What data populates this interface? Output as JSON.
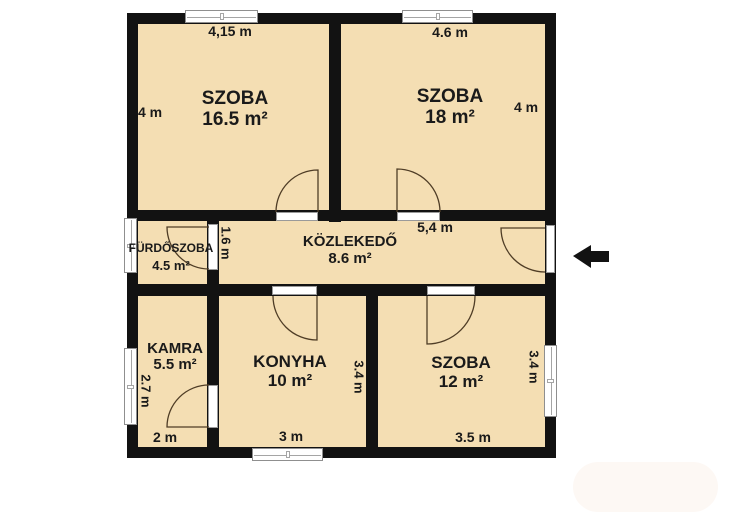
{
  "plan_type": "apartment-floor-plan",
  "colors": {
    "floor": "#f4deb3",
    "wall": "#121212",
    "text": "#1a1a1a",
    "door_arc": "#4f3d26",
    "window_frame": "#8f8f8f"
  },
  "rooms": [
    {
      "name": "SZOBA",
      "area": "16.5 m²"
    },
    {
      "name": "SZOBA",
      "area": "18 m²"
    },
    {
      "name": "FÜRDŐSZOBA",
      "area": "4.5 m²"
    },
    {
      "name": "KÖZLEKEDŐ",
      "area": "8.6 m²"
    },
    {
      "name": "KAMRA",
      "area": "5.5 m²"
    },
    {
      "name": "KONYHA",
      "area": "10 m²"
    },
    {
      "name": "SZOBA",
      "area": "12 m²"
    }
  ],
  "dimensions": {
    "szoba165_width": "4,15 m",
    "szoba165_height": "4 m",
    "szoba18_width": "4.6 m",
    "szoba18_height": "4 m",
    "hall_left_height": "1.6 m",
    "hall_width": "5,4 m",
    "kamra_height": "2.7 m",
    "kamra_width": "2 m",
    "konyha_width": "3 m",
    "konyha_height": "3.4 m",
    "szoba12_width": "3.5 m",
    "szoba12_height": "3.4 m"
  }
}
